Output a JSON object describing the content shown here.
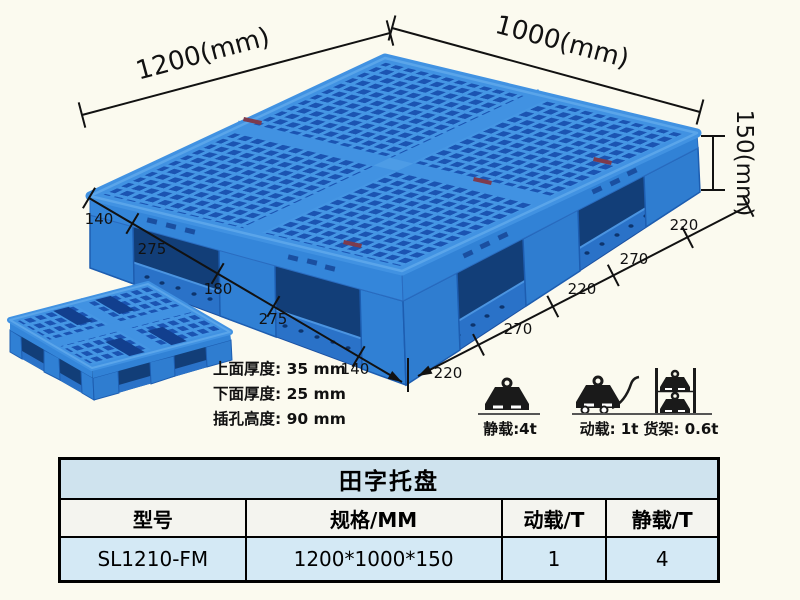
{
  "product": {
    "title": "田字托盘",
    "model": "SL1210-FM",
    "spec": "1200*1000*150"
  },
  "dimensions": {
    "width_label": "1200(mm)",
    "depth_label": "1000(mm)",
    "height_label": "150(mm)",
    "left_edge_segments": [
      "140",
      "275",
      "180",
      "275",
      "140"
    ],
    "right_edge_segments": [
      "220",
      "270",
      "220",
      "270",
      "220"
    ]
  },
  "annotations": {
    "top_thickness": "上面厚度: 35 mm",
    "bottom_thickness": "下面厚度: 25 mm",
    "fork_hole_height": "插孔高度: 90 mm"
  },
  "load_icons": [
    {
      "name": "static-load",
      "label": "静载:4t"
    },
    {
      "name": "dynamic-load",
      "label": "动载: 1t"
    },
    {
      "name": "rack-load",
      "label": "货架: 0.6t"
    }
  ],
  "table": {
    "title": "田字托盘",
    "headers": [
      "型号",
      "规格/MM",
      "动载/T",
      "静载/T"
    ],
    "rows": [
      [
        "SL1210-FM",
        "1200*1000*150",
        "1",
        "4"
      ]
    ]
  },
  "colors": {
    "pallet_rib": "#4596e4",
    "pallet_hole": "#1b54b2",
    "pallet_side": "#3080d4",
    "pallet_recess": "#123e78",
    "table_title_bg": "#cfe3ee",
    "table_header_bg": "#f4f4ef",
    "table_data_bg": "#d4e9f5",
    "line_color": "#111111",
    "background": "#fbfaef"
  }
}
